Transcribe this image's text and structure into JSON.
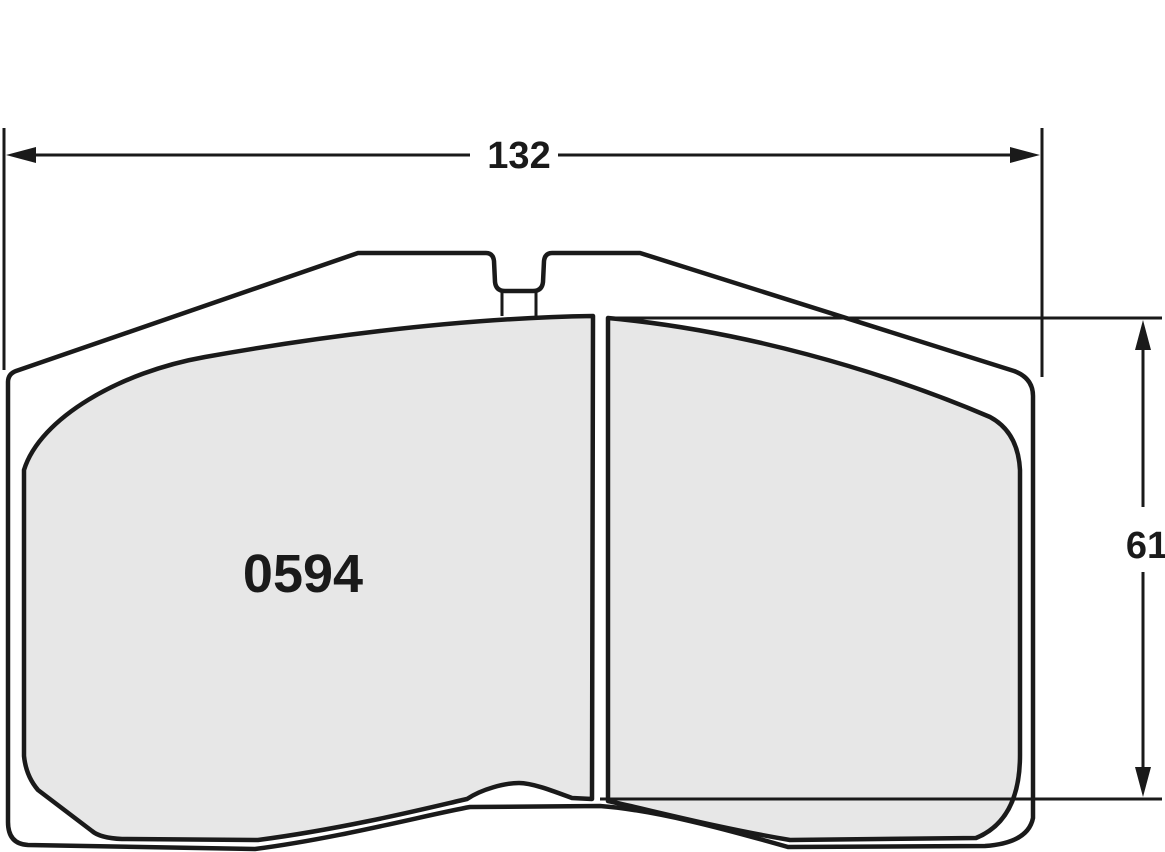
{
  "drawing": {
    "part_number": "0594",
    "width_dimension": "132",
    "height_dimension": "61"
  },
  "colors": {
    "background": "#ffffff",
    "line": "#1a1a1a",
    "plate_fill": "#ffffff",
    "friction_fill": "#e7e7e7",
    "text": "#1a1a1a"
  }
}
